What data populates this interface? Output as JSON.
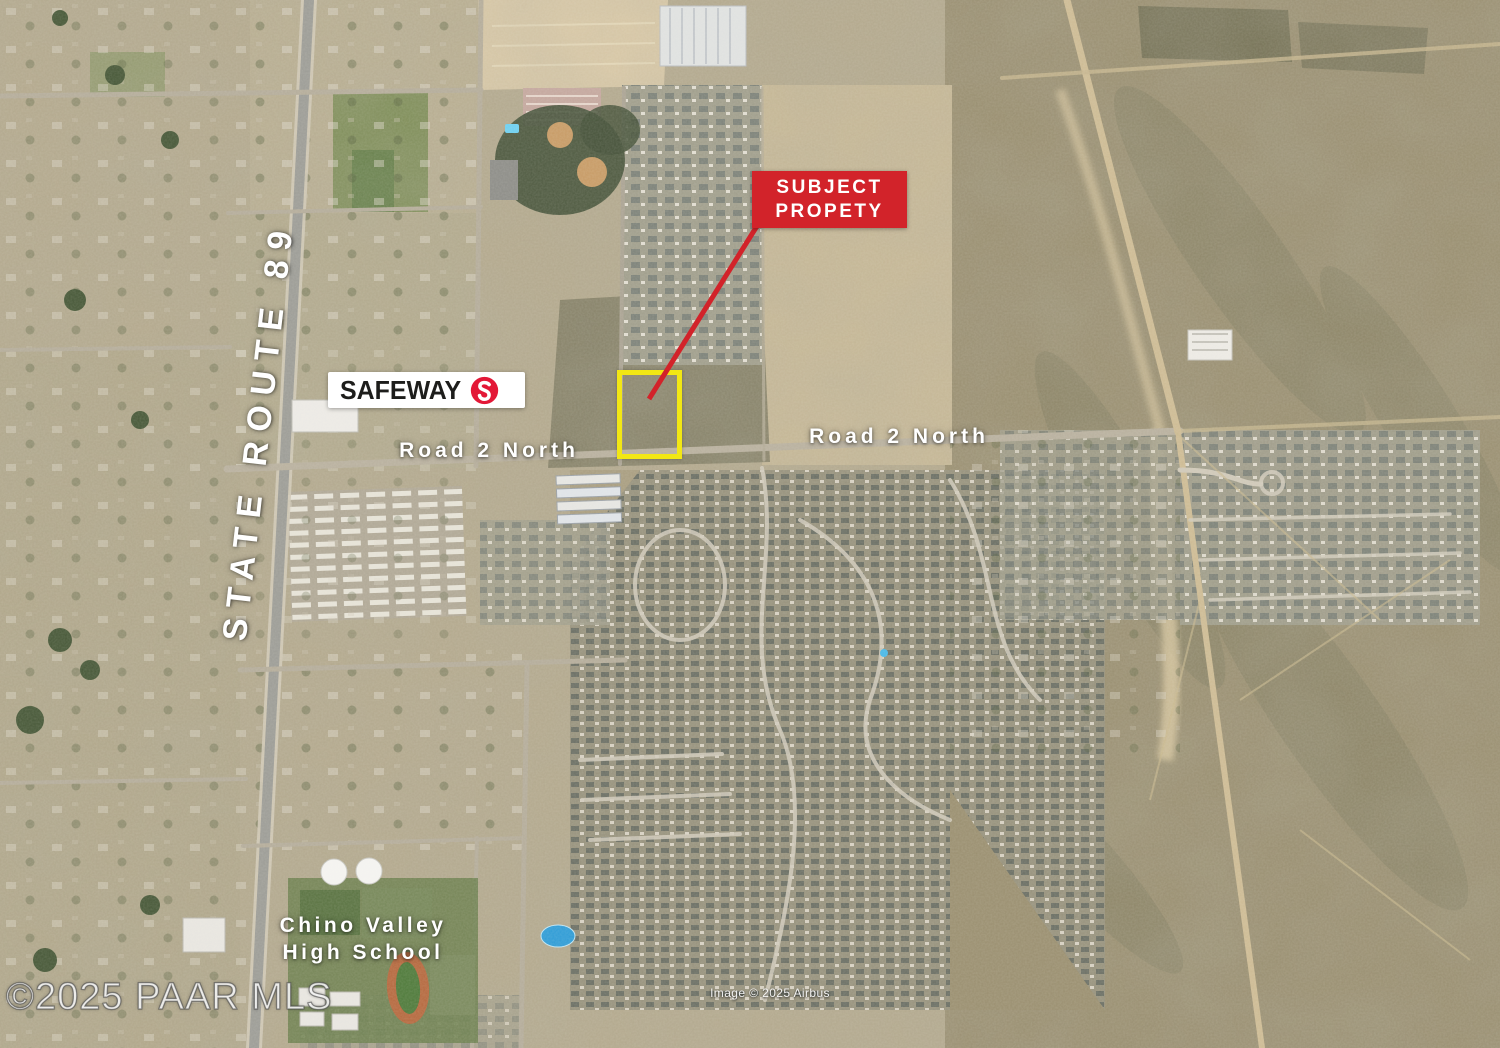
{
  "annotations": {
    "state_route_label": "STATE ROUTE 89",
    "road_labels": [
      {
        "text": "Road 2 North",
        "position": "west"
      },
      {
        "text": "Road 2 North",
        "position": "east"
      }
    ],
    "subject_callout": {
      "line1": "SUBJECT",
      "line2": "PROPETY"
    },
    "school_label": {
      "line1": "Chino Valley",
      "line2": "High School"
    },
    "safeway": {
      "name": "SAFEWAY"
    },
    "watermark": "©2025 PAAR MLS",
    "imagery_credit": "Image © 2025 Airbus"
  },
  "colors": {
    "callout_red": "#D2232A",
    "parcel_outline_yellow": "#F2E714",
    "label_white": "#FFFFFF",
    "safeway_emblem_red": "#E31837",
    "safeway_wordmark_black": "#1D1D1B"
  }
}
